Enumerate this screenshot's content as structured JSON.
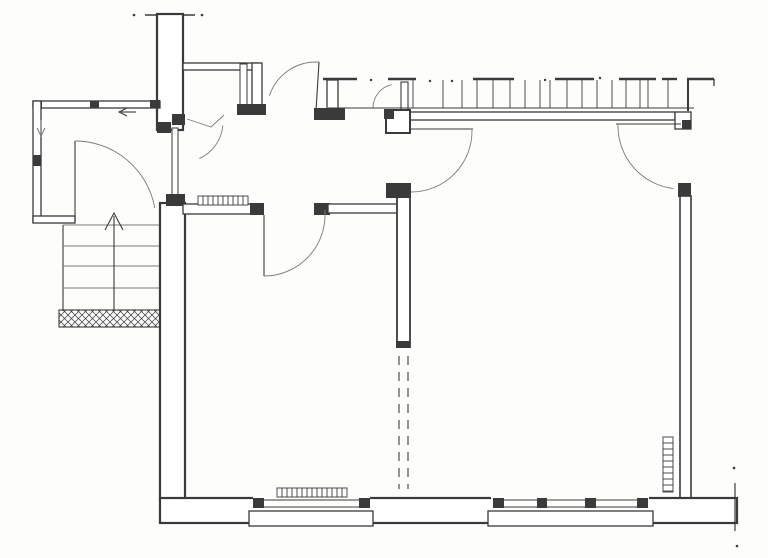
{
  "plan": {
    "canvas": {
      "width": 768,
      "height": 558,
      "paper": "#fdfdfc",
      "ink": "#3a3a3a",
      "light": "#7a7a7a"
    },
    "elements": [
      {
        "name": "chimney-wall",
        "type": "rect",
        "x": 157,
        "y": 14,
        "w": 26,
        "h": 116,
        "sw": 2.2
      },
      {
        "name": "chimney-top-tick-left",
        "type": "line",
        "x1": 145,
        "y1": 15,
        "x2": 156,
        "y2": 15,
        "sw": 1.5
      },
      {
        "name": "chimney-top-tick-right",
        "type": "line",
        "x1": 184,
        "y1": 15,
        "x2": 195,
        "y2": 15,
        "sw": 1.5
      },
      {
        "name": "chimney-top-dots",
        "type": "dots",
        "pts": [
          [
            134,
            15
          ],
          [
            202,
            15
          ]
        ],
        "r": 1.3
      },
      {
        "name": "closet-top-wall",
        "type": "rect",
        "x": 183,
        "y": 63,
        "w": 75,
        "h": 7,
        "sw": 1.3
      },
      {
        "name": "closet-right-wall",
        "type": "rect",
        "x": 252,
        "y": 63,
        "w": 10,
        "h": 47,
        "sw": 1.3
      },
      {
        "name": "closet-door-panel",
        "type": "rect",
        "x": 240,
        "y": 64,
        "w": 7,
        "h": 44,
        "sw": 1
      },
      {
        "name": "closet-door-pier",
        "type": "blackrect",
        "x": 237,
        "y": 104,
        "w": 29,
        "h": 11
      },
      {
        "name": "closet-hook-mark",
        "type": "polyline",
        "pts": [
          [
            187,
            119
          ],
          [
            211,
            127
          ],
          [
            224,
            115
          ]
        ],
        "sw": 0.9,
        "c": "light"
      },
      {
        "name": "porch-top-wall",
        "type": "rect",
        "x": 33,
        "y": 101,
        "w": 127,
        "h": 7,
        "sw": 1.3
      },
      {
        "name": "porch-corner-post-nw",
        "type": "blackrect",
        "x": 33,
        "y": 101,
        "w": 9,
        "h": 8
      },
      {
        "name": "porch-top-post",
        "type": "blackrect",
        "x": 90,
        "y": 101,
        "w": 9,
        "h": 7
      },
      {
        "name": "porch-top-post-east",
        "type": "blackrect",
        "x": 150,
        "y": 100,
        "w": 10,
        "h": 8
      },
      {
        "name": "porch-left-wall",
        "type": "rect",
        "x": 33,
        "y": 101,
        "w": 8,
        "h": 121,
        "sw": 1.3
      },
      {
        "name": "porch-left-post",
        "type": "blackrect",
        "x": 33,
        "y": 155,
        "w": 8,
        "h": 11
      },
      {
        "name": "porch-bottom-wall",
        "type": "rect",
        "x": 33,
        "y": 216,
        "w": 42,
        "h": 7,
        "sw": 1.3
      },
      {
        "name": "porch-drain-arrow-shaft",
        "type": "line",
        "x1": 41,
        "y1": 120,
        "x2": 41,
        "y2": 134,
        "sw": 1,
        "c": "light"
      },
      {
        "name": "porch-drain-arrow-head",
        "type": "polyline",
        "pts": [
          [
            37,
            128
          ],
          [
            41,
            136
          ],
          [
            45,
            128
          ]
        ],
        "sw": 1,
        "c": "light"
      },
      {
        "name": "entry-direction-arrow-shaft",
        "type": "line",
        "x1": 121,
        "y1": 112,
        "x2": 136,
        "y2": 112,
        "sw": 1.1
      },
      {
        "name": "entry-direction-arrow-head",
        "type": "polyline",
        "pts": [
          [
            127,
            108
          ],
          [
            119,
            112
          ],
          [
            127,
            116
          ]
        ],
        "sw": 1.1
      },
      {
        "name": "porch-door-leaf",
        "type": "line",
        "x1": 75,
        "y1": 141,
        "x2": 75,
        "y2": 222,
        "sw": 1.1
      },
      {
        "name": "porch-door-swing",
        "type": "arc",
        "cx": 75,
        "cy": 222,
        "r": 81,
        "a1": 270,
        "a2": 350,
        "sw": 0.9,
        "c": "light"
      },
      {
        "name": "stairs-side-rail",
        "type": "line",
        "x1": 63,
        "y1": 225,
        "x2": 63,
        "y2": 311,
        "sw": 1.1
      },
      {
        "name": "stair-treads",
        "type": "rows",
        "ys": [
          225,
          246,
          266,
          288
        ],
        "x1": 63,
        "x2": 159,
        "sw": 1,
        "c": "light"
      },
      {
        "name": "stairs-up-arrow-shaft",
        "type": "line",
        "x1": 114,
        "y1": 311,
        "x2": 114,
        "y2": 216,
        "sw": 1.1
      },
      {
        "name": "stairs-up-arrow-head",
        "type": "polyline",
        "pts": [
          [
            105,
            230
          ],
          [
            114,
            213
          ],
          [
            123,
            230
          ]
        ],
        "sw": 1.1
      },
      {
        "name": "entry-mat",
        "type": "hatchrect",
        "x": 59,
        "y": 310,
        "w": 101,
        "h": 17,
        "step": 7,
        "sw": 1.1
      },
      {
        "name": "room-left-wall",
        "type": "rect",
        "x": 160,
        "y": 203,
        "w": 25,
        "h": 297,
        "sw": 2.2
      },
      {
        "name": "porch-hall-jamb-top-a",
        "type": "blackrect",
        "x": 157,
        "y": 122,
        "w": 14,
        "h": 11
      },
      {
        "name": "porch-hall-jamb-top-b",
        "type": "blackrect",
        "x": 172,
        "y": 114,
        "w": 13,
        "h": 11
      },
      {
        "name": "porch-hall-door-panel",
        "type": "rect",
        "x": 172,
        "y": 128,
        "w": 6,
        "h": 70,
        "sw": 1
      },
      {
        "name": "porch-hall-jamb-bottom",
        "type": "blackrect",
        "x": 166,
        "y": 194,
        "w": 19,
        "h": 12
      },
      {
        "name": "porch-hall-door-swing",
        "type": "arc",
        "cx": 183,
        "cy": 122,
        "r": 40,
        "a1": 5,
        "a2": 66,
        "sw": 0.9,
        "c": "light"
      },
      {
        "name": "hall-south-wall-west",
        "type": "rect",
        "x": 183,
        "y": 204,
        "w": 72,
        "h": 10,
        "sw": 1.3
      },
      {
        "name": "hall-radiator",
        "type": "tickedrect",
        "x": 198,
        "y": 196,
        "w": 50,
        "h": 9,
        "dir": "v",
        "step": 5,
        "sw": 0.9
      },
      {
        "name": "hall-door1-jamb-west",
        "type": "blackrect",
        "x": 250,
        "y": 203,
        "w": 14,
        "h": 12
      },
      {
        "name": "hall-door1-jamb-east",
        "type": "blackrect",
        "x": 314,
        "y": 203,
        "w": 16,
        "h": 12
      },
      {
        "name": "hall-south-wall-east",
        "type": "rect",
        "x": 328,
        "y": 204,
        "w": 69,
        "h": 9,
        "sw": 1.3
      },
      {
        "name": "hall-door1-leaf",
        "type": "line",
        "x1": 264,
        "y1": 215,
        "x2": 264,
        "y2": 276,
        "sw": 1.1
      },
      {
        "name": "hall-door1-swing",
        "type": "arc",
        "cx": 264,
        "cy": 215,
        "r": 61,
        "a1": 90,
        "a2": -5,
        "sw": 0.9,
        "c": "light"
      },
      {
        "name": "hall-door2-leaf",
        "type": "line",
        "x1": 316,
        "y1": 111,
        "x2": 319,
        "y2": 62,
        "sw": 1.1
      },
      {
        "name": "hall-door2-swing",
        "type": "arc",
        "cx": 316,
        "cy": 111,
        "r": 49,
        "a1": -86,
        "a2": -162,
        "sw": 0.9,
        "c": "light"
      },
      {
        "name": "balcony-pier",
        "type": "rect",
        "x": 327,
        "y": 80,
        "w": 11,
        "h": 30,
        "sw": 1.3
      },
      {
        "name": "balcony-pier-base",
        "type": "blackrect",
        "x": 314,
        "y": 108,
        "w": 31,
        "h": 12
      },
      {
        "name": "balcony-door-jamb-post",
        "type": "rect",
        "x": 401,
        "y": 82,
        "w": 7,
        "h": 28,
        "sw": 1.1
      },
      {
        "name": "balcony-door-swing",
        "type": "arc",
        "cx": 397,
        "cy": 108,
        "r": 24,
        "a1": 181,
        "a2": 257,
        "sw": 0.9,
        "c": "light"
      },
      {
        "name": "balcony-edge-line",
        "type": "line",
        "x1": 328,
        "y1": 108,
        "x2": 694,
        "y2": 108,
        "sw": 1
      },
      {
        "name": "bigroom-top-wall",
        "type": "rect",
        "x": 408,
        "y": 112,
        "w": 267,
        "h": 8,
        "sw": 1.3
      },
      {
        "name": "topwall-east-jog",
        "type": "rect",
        "x": 675,
        "y": 112,
        "w": 16,
        "h": 17,
        "sw": 1.3
      },
      {
        "name": "topwall-east-jog-block",
        "type": "blackrect",
        "x": 682,
        "y": 120,
        "w": 9,
        "h": 9
      },
      {
        "name": "bigroom-corner-block",
        "type": "rect",
        "x": 386,
        "y": 110,
        "w": 24,
        "h": 23,
        "sw": 2
      },
      {
        "name": "bigroom-corner-notch",
        "type": "blackrect",
        "x": 384,
        "y": 109,
        "w": 10,
        "h": 10
      },
      {
        "name": "pergola-posts",
        "type": "vticks",
        "xs": [
          413,
          443,
          462,
          477,
          493,
          510,
          525,
          540,
          550,
          567,
          582,
          597,
          612,
          626,
          640,
          648,
          668
        ],
        "y1": 108,
        "y2": 80,
        "sw": 0.9
      },
      {
        "name": "pergola-end-post",
        "type": "line",
        "x1": 688,
        "y1": 79,
        "x2": 688,
        "y2": 111,
        "sw": 2
      },
      {
        "name": "pergola-caps",
        "type": "hsegs",
        "segs": [
          [
            323,
            357
          ],
          [
            388,
            416
          ],
          [
            473,
            514
          ],
          [
            555,
            594
          ],
          [
            619,
            656
          ],
          [
            662,
            677
          ],
          [
            687,
            714
          ]
        ],
        "y": 79,
        "sw": 2.4
      },
      {
        "name": "pergola-cap-end-tick",
        "type": "line",
        "x1": 714,
        "y1": 79,
        "x2": 714,
        "y2": 86,
        "sw": 1.3
      },
      {
        "name": "pergola-dots",
        "type": "dots",
        "pts": [
          [
            371,
            80
          ],
          [
            430,
            81
          ],
          [
            452,
            81
          ],
          [
            545,
            80
          ],
          [
            600,
            78
          ]
        ],
        "r": 1.2
      },
      {
        "name": "bigroom-door-leaf",
        "type": "line",
        "x1": 411,
        "y1": 129,
        "x2": 473,
        "y2": 129,
        "sw": 1.1
      },
      {
        "name": "bigroom-door-swing",
        "type": "arc",
        "cx": 411,
        "cy": 131,
        "r": 61,
        "a1": -1,
        "a2": 90,
        "sw": 0.9,
        "c": "light"
      },
      {
        "name": "bigroom-west-wall",
        "type": "rect",
        "x": 397,
        "y": 196,
        "w": 13,
        "h": 151,
        "sw": 1.8
      },
      {
        "name": "bigroom-west-pier",
        "type": "blackrect",
        "x": 386,
        "y": 183,
        "w": 25,
        "h": 15
      },
      {
        "name": "bigroom-west-wall-endcap",
        "type": "blackrect",
        "x": 396,
        "y": 341,
        "w": 14,
        "h": 7
      },
      {
        "name": "future-wall-dash-west",
        "type": "line",
        "x1": 399,
        "y1": 356,
        "x2": 399,
        "y2": 489,
        "sw": 1.1,
        "dash": "9,7"
      },
      {
        "name": "future-wall-dash-east",
        "type": "line",
        "x1": 408,
        "y1": 356,
        "x2": 408,
        "y2": 489,
        "sw": 1.1,
        "dash": "9,7"
      },
      {
        "name": "rightwall-door-leaf",
        "type": "line",
        "x1": 616,
        "y1": 124,
        "x2": 681,
        "y2": 124,
        "sw": 1.1
      },
      {
        "name": "rightwall-door-swing",
        "type": "arc",
        "cx": 681,
        "cy": 126,
        "r": 63,
        "a1": 181,
        "a2": 97,
        "sw": 0.9,
        "c": "light"
      },
      {
        "name": "bigroom-east-pier",
        "type": "blackrect",
        "x": 678,
        "y": 183,
        "w": 13,
        "h": 14
      },
      {
        "name": "bigroom-east-wall",
        "type": "rect",
        "x": 680,
        "y": 196,
        "w": 11,
        "h": 304,
        "sw": 1.6
      },
      {
        "name": "bottom-wall",
        "type": "rect",
        "x": 160,
        "y": 498,
        "w": 577,
        "h": 25,
        "sw": 2.2
      },
      {
        "name": "window-left-gap",
        "type": "fillrect",
        "x": 253,
        "y": 496,
        "w": 117,
        "h": 29
      },
      {
        "name": "window-left-glazing-outer",
        "type": "line",
        "x1": 253,
        "y1": 500,
        "x2": 370,
        "y2": 500,
        "sw": 1
      },
      {
        "name": "window-left-glazing-inner",
        "type": "line",
        "x1": 253,
        "y1": 507,
        "x2": 370,
        "y2": 507,
        "sw": 1
      },
      {
        "name": "window-left-jamb-west",
        "type": "blackrect",
        "x": 253,
        "y": 498,
        "w": 11,
        "h": 10
      },
      {
        "name": "window-left-jamb-east",
        "type": "blackrect",
        "x": 359,
        "y": 498,
        "w": 11,
        "h": 10
      },
      {
        "name": "window-left-sill",
        "type": "rect",
        "x": 249,
        "y": 511,
        "w": 124,
        "h": 15,
        "sw": 1.3
      },
      {
        "name": "window-left-radiator",
        "type": "tickedrect",
        "x": 277,
        "y": 488,
        "w": 70,
        "h": 9,
        "dir": "v",
        "step": 5,
        "sw": 0.9
      },
      {
        "name": "window-right-gap",
        "type": "fillrect",
        "x": 491,
        "y": 496,
        "w": 158,
        "h": 29
      },
      {
        "name": "window-right-glazing-outer",
        "type": "line",
        "x1": 493,
        "y1": 500,
        "x2": 647,
        "y2": 500,
        "sw": 1
      },
      {
        "name": "window-right-glazing-inner",
        "type": "line",
        "x1": 493,
        "y1": 507,
        "x2": 647,
        "y2": 507,
        "sw": 1
      },
      {
        "name": "window-right-jamb-west",
        "type": "blackrect",
        "x": 493,
        "y": 498,
        "w": 11,
        "h": 10
      },
      {
        "name": "window-right-jamb-east",
        "type": "blackrect",
        "x": 637,
        "y": 498,
        "w": 11,
        "h": 10
      },
      {
        "name": "window-right-mullion-a",
        "type": "blackrect",
        "x": 537,
        "y": 498,
        "w": 10,
        "h": 10
      },
      {
        "name": "window-right-mullion-b",
        "type": "blackrect",
        "x": 585,
        "y": 498,
        "w": 11,
        "h": 10
      },
      {
        "name": "window-right-sill",
        "type": "rect",
        "x": 488,
        "y": 511,
        "w": 165,
        "h": 15,
        "sw": 1.3
      },
      {
        "name": "bottomwall-end-cut-line",
        "type": "line",
        "x1": 735,
        "y1": 483,
        "x2": 735,
        "y2": 531,
        "sw": 1.2
      },
      {
        "name": "end-cut-dots",
        "type": "dots",
        "pts": [
          [
            734,
            468
          ],
          [
            737,
            546
          ]
        ],
        "r": 1.3
      },
      {
        "name": "bigroom-radiator",
        "type": "tickedrect",
        "x": 663,
        "y": 437,
        "w": 10,
        "h": 55,
        "dir": "h",
        "step": 6,
        "sw": 0.9
      }
    ]
  }
}
